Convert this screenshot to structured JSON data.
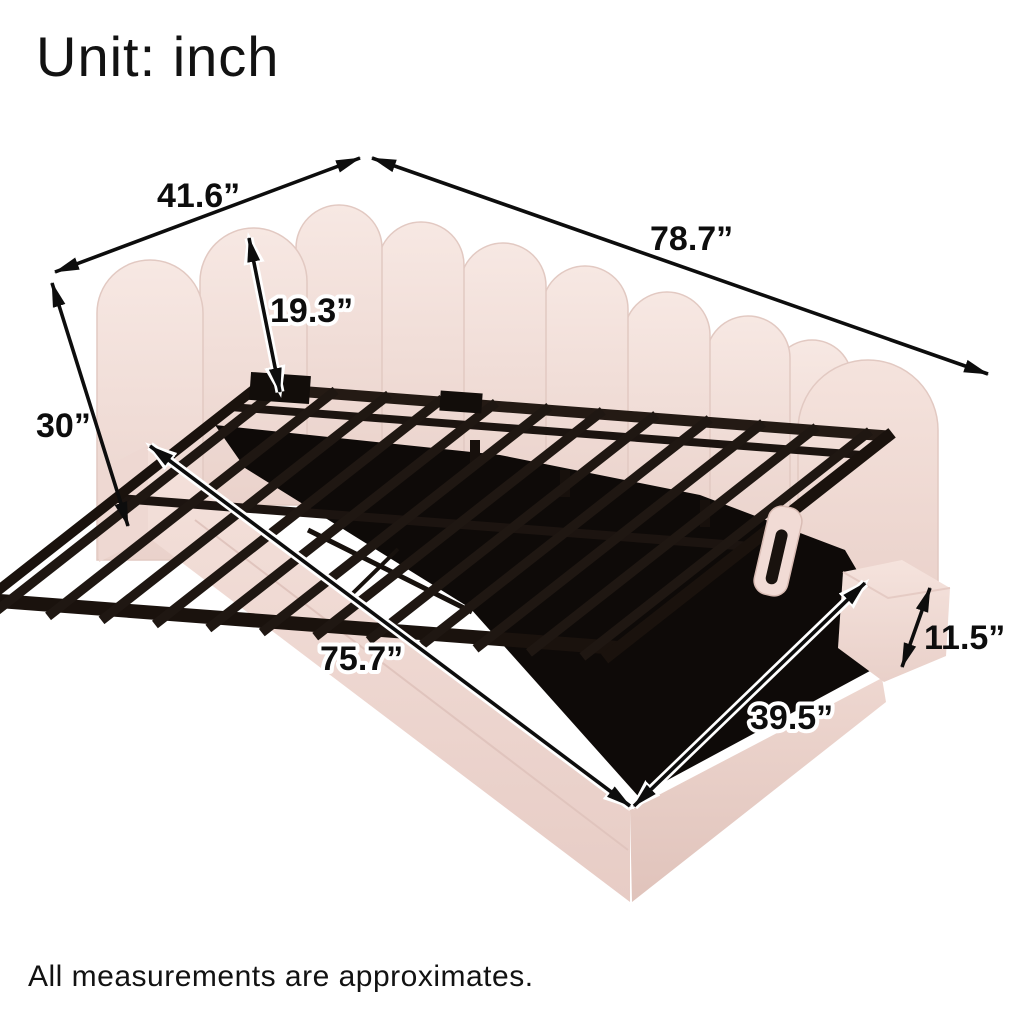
{
  "title": "Unit: inch",
  "unit": "inch",
  "footnote": "All measurements are approximates.",
  "product": {
    "name": "Upholstered daybed with scalloped backrest and lift-up storage slat frame",
    "upholstery_color_name": "pink",
    "frame_color_name": "black"
  },
  "dimensions": [
    {
      "id": "side-depth",
      "label": "41.6”",
      "value": 41.6,
      "description": "head-side width (left side)"
    },
    {
      "id": "overall-length",
      "label": "78.7”",
      "value": 78.7,
      "description": "overall length along backrest"
    },
    {
      "id": "backrest-panel-height",
      "label": "19.3”",
      "value": 19.3,
      "description": "backrest panel height above base"
    },
    {
      "id": "overall-height",
      "label": "30”",
      "value": 30,
      "description": "overall height"
    },
    {
      "id": "front-length",
      "label": "75.7”",
      "value": 75.7,
      "description": "front rail length"
    },
    {
      "id": "bed-width",
      "label": "39.5”",
      "value": 39.5,
      "description": "bed width at foot end"
    },
    {
      "id": "side-rail-height",
      "label": "11.5”",
      "value": 11.5,
      "description": "side rail / base height"
    }
  ],
  "colors": {
    "background": "#ffffff",
    "upholstery_light": "#f7e8e3",
    "upholstery_mid": "#f0dad4",
    "upholstery_shadow": "#e7cdc6",
    "frame_metal": "#1f1712",
    "storage_cavity": "#0e0a08",
    "dimension_lines": "#0d0d0d",
    "text": "#121212"
  }
}
